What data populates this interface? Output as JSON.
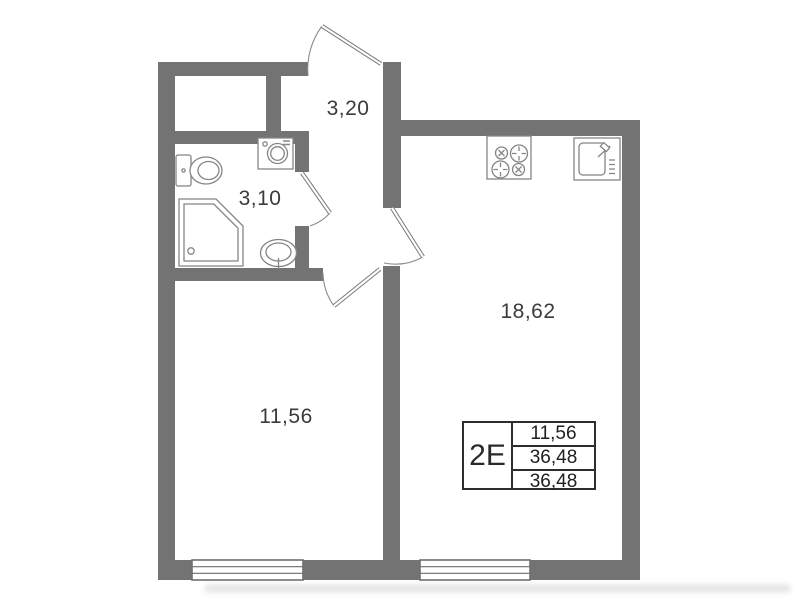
{
  "plan": {
    "unit_type": "2E",
    "room_areas": {
      "hallway": "3,20",
      "bathroom": "3,10",
      "living_room": "11,56",
      "kitchen_living": "18,62"
    },
    "summary_table": {
      "unit_type": "2E",
      "rows": [
        "11,56",
        "36,48",
        "36,48"
      ]
    },
    "colors": {
      "wall": "#737373",
      "fixture_line": "#858585",
      "label_text": "#3b3b3b",
      "table_border": "#2d2d2d"
    },
    "icons": {
      "stove": "stove-icon",
      "kitchen_sink": "kitchen-sink-icon",
      "toilet": "toilet-icon",
      "shower": "shower-icon",
      "washing_machine": "washing-machine-icon",
      "bathroom_sink": "bathroom-sink-icon",
      "entrance_door": "door-swing-icon"
    }
  }
}
